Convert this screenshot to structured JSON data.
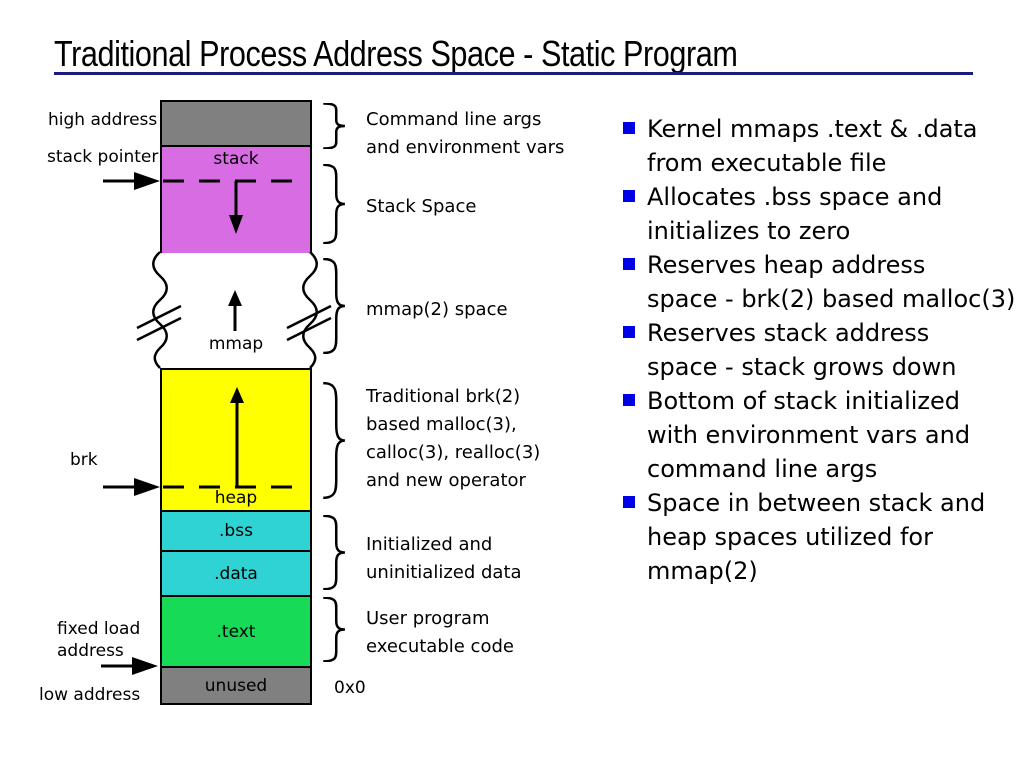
{
  "slide": {
    "title": "Traditional Process Address Space - Static Program"
  },
  "diagram": {
    "side_labels": {
      "high_address": "high address",
      "stack_pointer": "stack pointer",
      "brk": "brk",
      "fixed_load_address": "fixed load\naddress",
      "low_address": "low address",
      "origin": "0x0"
    },
    "boxes": [
      {
        "name": "args-env",
        "label": "",
        "color": "#808080"
      },
      {
        "name": "stack",
        "label": "stack",
        "color": "#d76ce3"
      },
      {
        "name": "mmap-gap",
        "label": "mmap",
        "color": "#ffffff"
      },
      {
        "name": "heap",
        "label": "heap",
        "color": "#ffff00"
      },
      {
        "name": "bss",
        "label": ".bss",
        "color": "#2fd3d3"
      },
      {
        "name": "data",
        "label": ".data",
        "color": "#2fd3d3"
      },
      {
        "name": "text",
        "label": ".text",
        "color": "#17da57"
      },
      {
        "name": "unused",
        "label": "unused",
        "color": "#808080"
      }
    ],
    "brace_labels": [
      "Command line args\nand environment vars",
      "Stack Space",
      "mmap(2) space",
      "Traditional brk(2)\nbased malloc(3),\ncalloc(3), realloc(3)\nand new operator",
      "Initialized and\nuninitialized data",
      "User program\nexecutable code"
    ]
  },
  "bullets": [
    "Kernel mmaps .text & .data\nfrom executable file",
    "Allocates .bss space and\ninitializes to zero",
    "Reserves heap address\nspace - brk(2) based malloc(3)",
    "Reserves stack address\nspace - stack grows down",
    "Bottom of stack initialized\nwith environment vars and\ncommand line args",
    "Space in between stack and\nheap spaces utilized for\nmmap(2)"
  ],
  "colors": {
    "title_rule": "#1b1b7e",
    "bullet_square": "#0000e8",
    "line": "#000000"
  }
}
